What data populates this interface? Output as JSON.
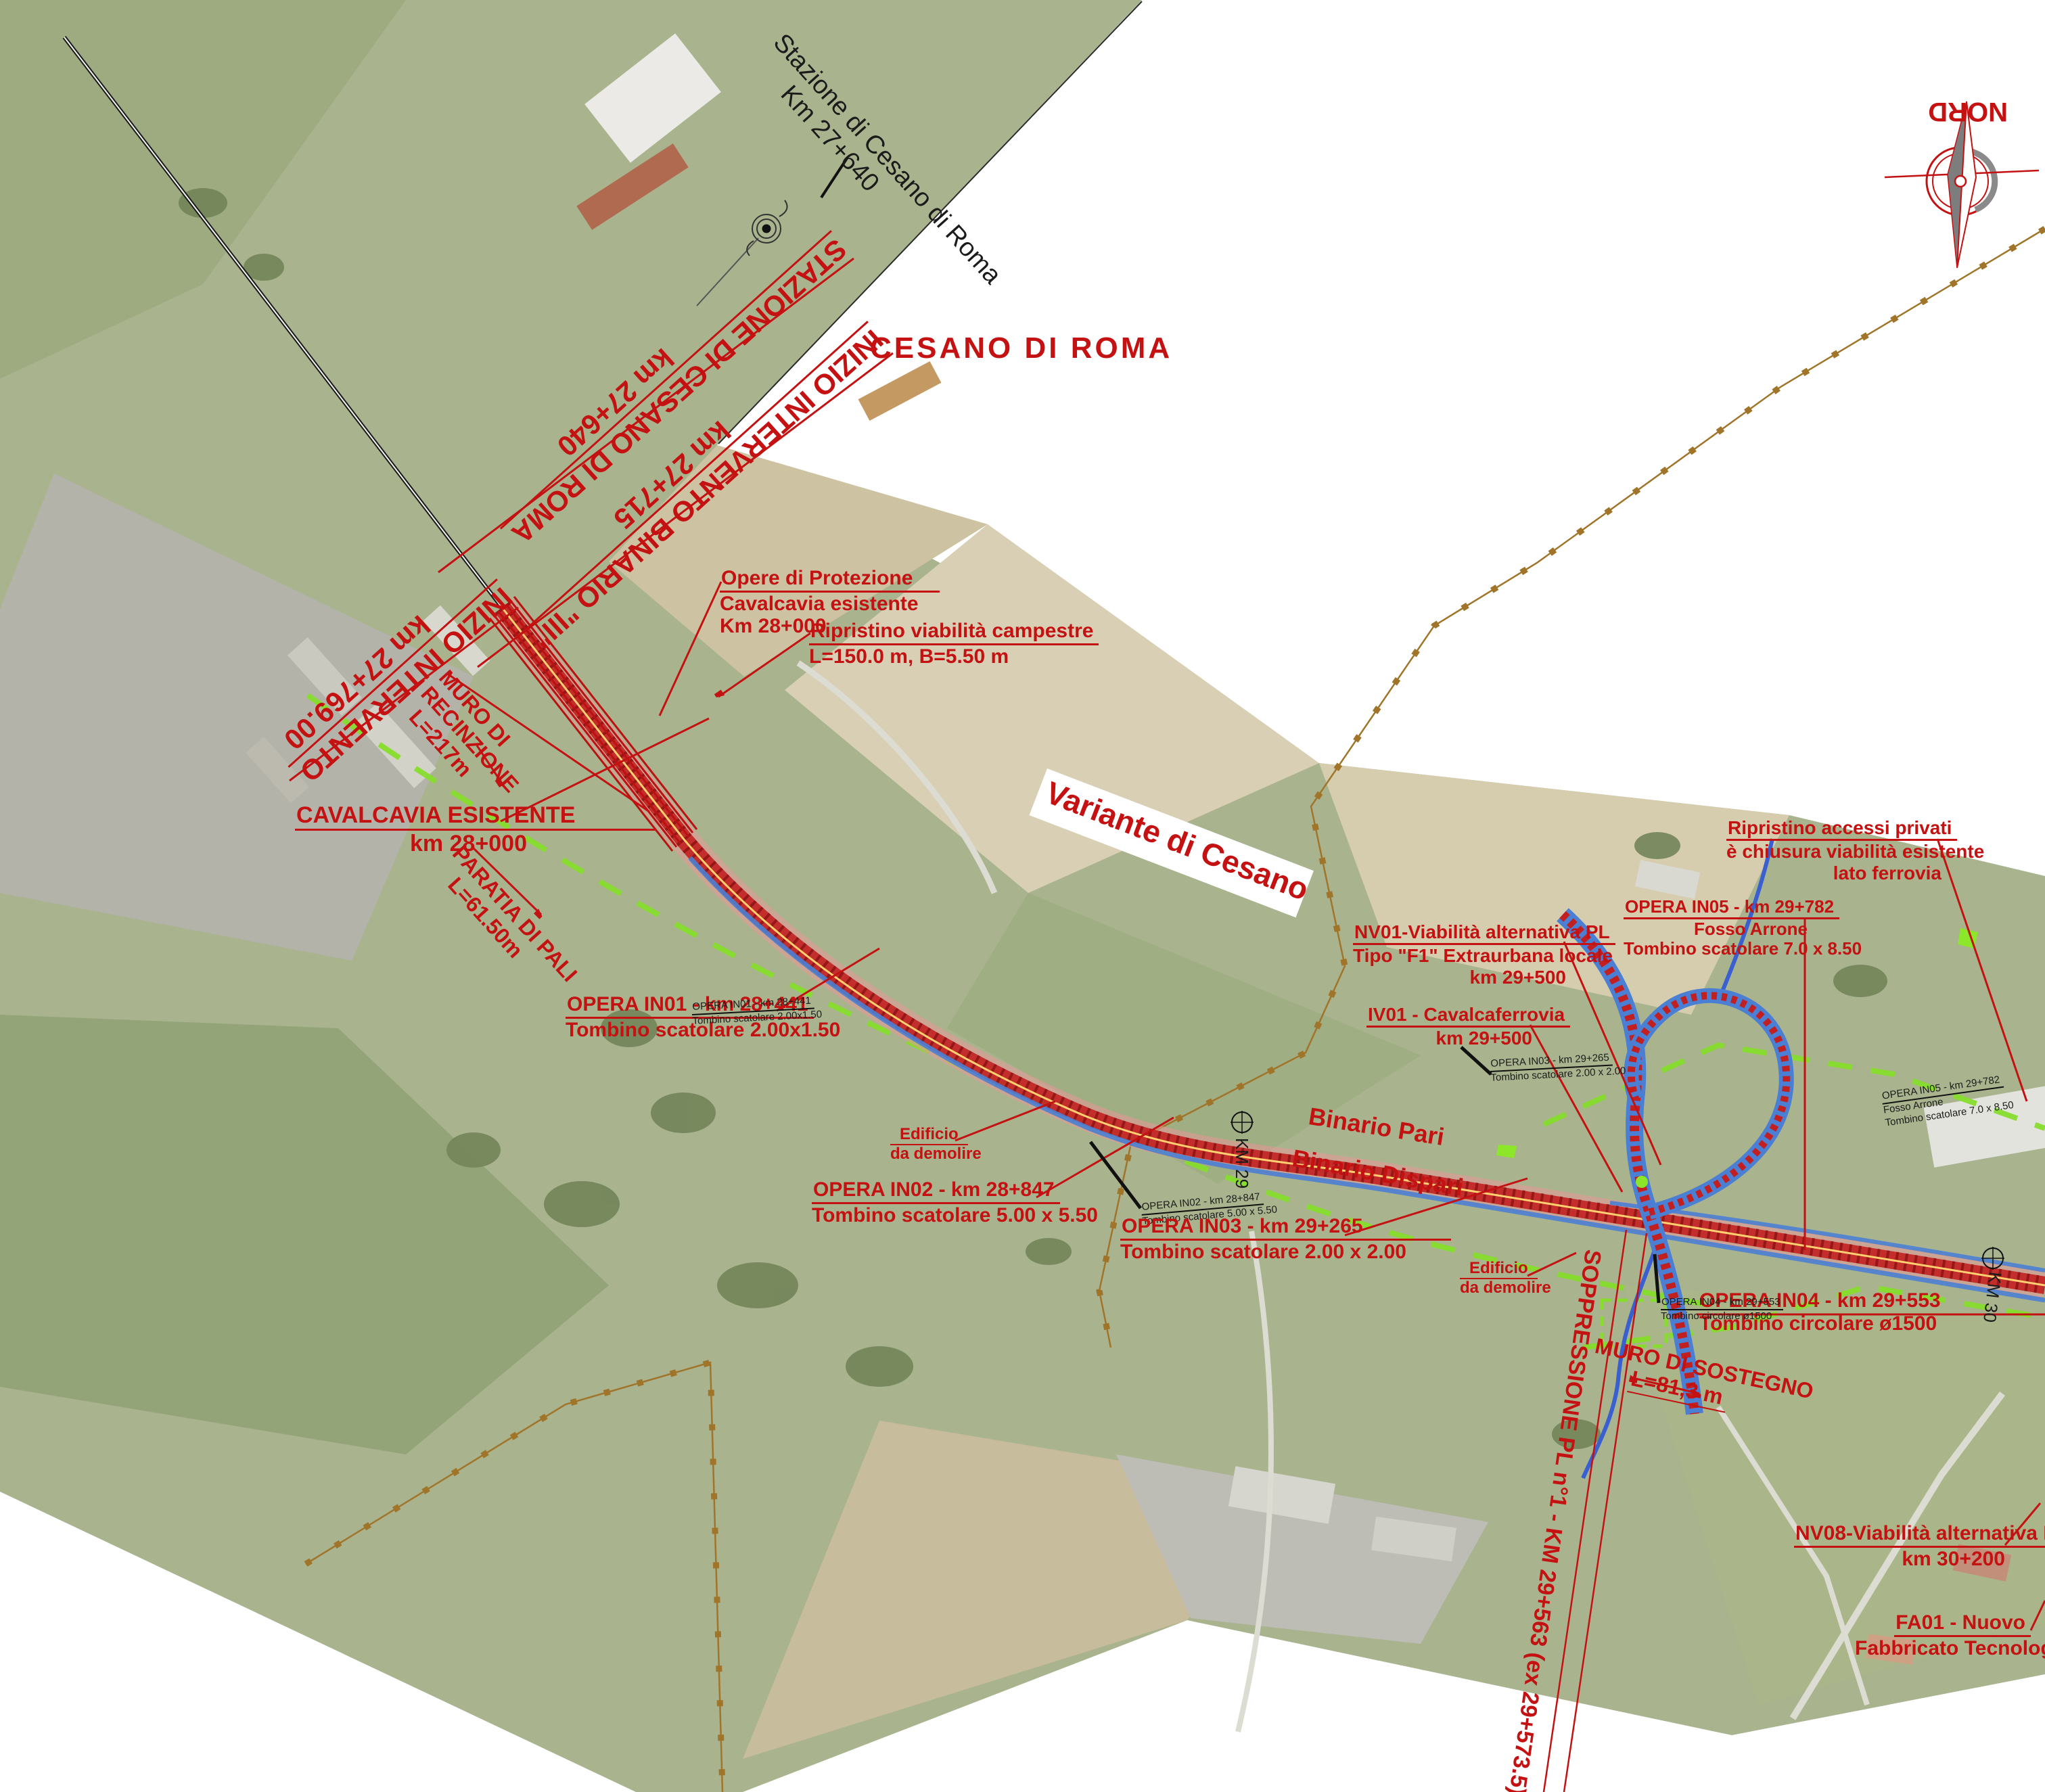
{
  "map": {
    "place_title": "CESANO DI ROMA",
    "scheme_title": "Variante di Cesano",
    "north_label": "NORD",
    "colors": {
      "annotation_red": "#c41111",
      "corridor_red": "#bb1d1d",
      "boundary_orange": "#a0752a",
      "road_blue": "#4a7fd4",
      "dashed_green": "#86dd2b",
      "stream_blue": "#3a5fd0"
    }
  },
  "labels": {
    "stazione_nera": {
      "l1": "Stazione di Cesano di Roma",
      "l2": "Km 27+640"
    },
    "stazione_rossa": {
      "l1": "STAZIONE DI CESANO DI ROMA",
      "l2": "km 27+640"
    },
    "inizio_binario": {
      "l1": "INIZIO INTERVENTO BINARIO \"III\"",
      "l2": "km 27+715"
    },
    "inizio_intervento": {
      "l1": "INIZIO INTERVENTO",
      "l2": "km 27+769.00"
    },
    "muro_recinzione": {
      "l1": "MURO DI",
      "l2": "RECINZIONE",
      "l3": "L=217m"
    },
    "cavalcavia_esistente": {
      "l1": "CAVALCAVIA ESISTENTE",
      "l2": "km 28+000"
    },
    "paratia": {
      "l1": "PARATIA DI PALI",
      "l2": "L=61.50m"
    },
    "opere_protezione": {
      "l1": "Opere di Protezione",
      "l2": "Cavalcavia esistente",
      "l3": "Km 28+000"
    },
    "ripristino_campestre": {
      "l1": "Ripristino viabilità campestre",
      "l2": "L=150.0 m, B=5.50 m"
    },
    "opera_in01": {
      "l1": "OPERA IN01 -  km 28+441",
      "l2": "Tombino scatolare 2.00x1.50"
    },
    "opera_in02": {
      "l1": "OPERA IN02 -  km 28+847",
      "l2": "Tombino scatolare 5.00 x 5.50"
    },
    "opera_in03": {
      "l1": "OPERA IN03 -  km 29+265",
      "l2": "Tombino scatolare 2.00 x 2.00"
    },
    "opera_in04": {
      "l1": "OPERA IN04 -  km 29+553",
      "l2": "Tombino circolare ø1500"
    },
    "opera_in05": {
      "l1": "OPERA IN05 -  km 29+782",
      "l2": "Fosso Arrone",
      "l3": "Tombino scatolare 7.0 x 8.50"
    },
    "edificio": {
      "l1": "Edificio",
      "l2": "da demolire"
    },
    "binario_pari": "Binario Pari",
    "binario_dispari": "Binario Dispari",
    "km29": "KM 29",
    "km30": "KM 30",
    "nv01": {
      "l1": "NV01-Viabilità alternativa PL",
      "l2": "Tipo \"F1\" Extraurbana locale",
      "l3": "km 29+500"
    },
    "iv01": {
      "l1": "IV01 - Cavalcaferrovia",
      "l2": "km 29+500"
    },
    "ripristino_accessi": {
      "l1": "Ripristino accessi privati",
      "l2": "è chiusura viabilità esistente",
      "l3": "lato ferrovia"
    },
    "muro_sostegno": {
      "l1": "MURO DI SOSTEGNO",
      "l2": "L=81,3 m"
    },
    "soppressione": "SOPPRESSIONE PL n°1 - KM 29+563 (ex 29+573.5)",
    "nv08": {
      "l1": "NV08-Viabilità alternativa PL",
      "l2": "km 30+200"
    },
    "fa01": {
      "l1": "FA01 - Nuovo",
      "l2": "Fabbricato Tecnologico"
    }
  }
}
